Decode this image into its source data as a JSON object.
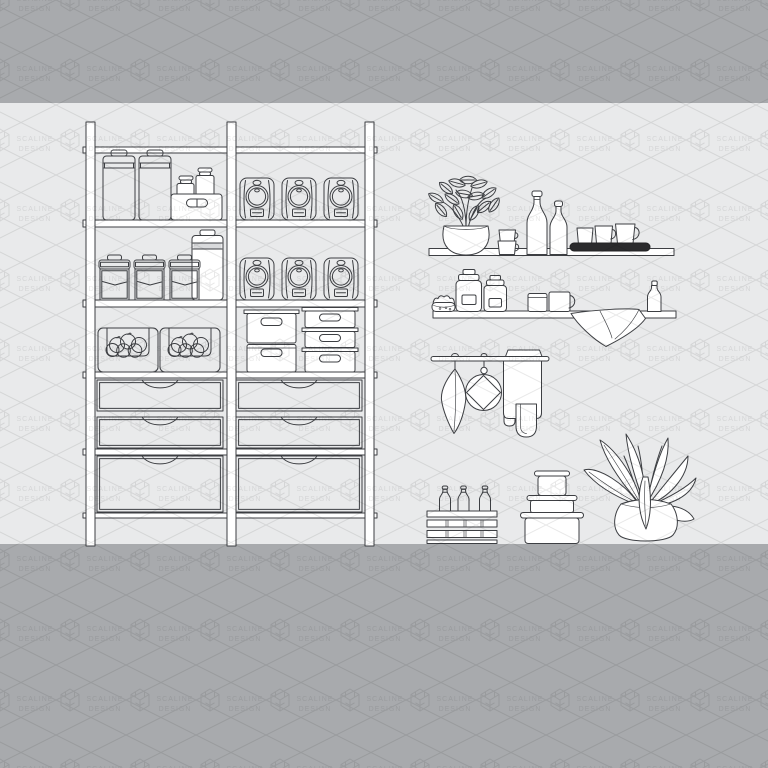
{
  "watermark": {
    "line1": "SCALINE",
    "line2": "DESIGN"
  },
  "colors": {
    "band_dark": "#a8aaad",
    "band_light": "#e9eaeb",
    "line": "#3d3f43",
    "fill": "#ffffff",
    "tray": "#2b2b2d",
    "watermark_ink": "#000000"
  },
  "scene": {
    "items": [
      "storage-shelving-unit",
      "lidded-canisters",
      "spice-jar-bin",
      "coffee-bags",
      "flour-canisters",
      "fruit-baskets",
      "storage-bins",
      "stacked-containers",
      "shelf-drawers",
      "wall-shelf-top",
      "plant-in-vase",
      "stacked-cups",
      "bottles",
      "mug-tray",
      "wall-shelf-bottom",
      "jam-jar",
      "clip-top-jars",
      "mugs",
      "small-bottle",
      "draped-towel",
      "hanging-rail",
      "tea-towel",
      "pot-holder",
      "hand-towels",
      "bottle-crate",
      "nesting-food-containers",
      "potted-plant"
    ]
  }
}
